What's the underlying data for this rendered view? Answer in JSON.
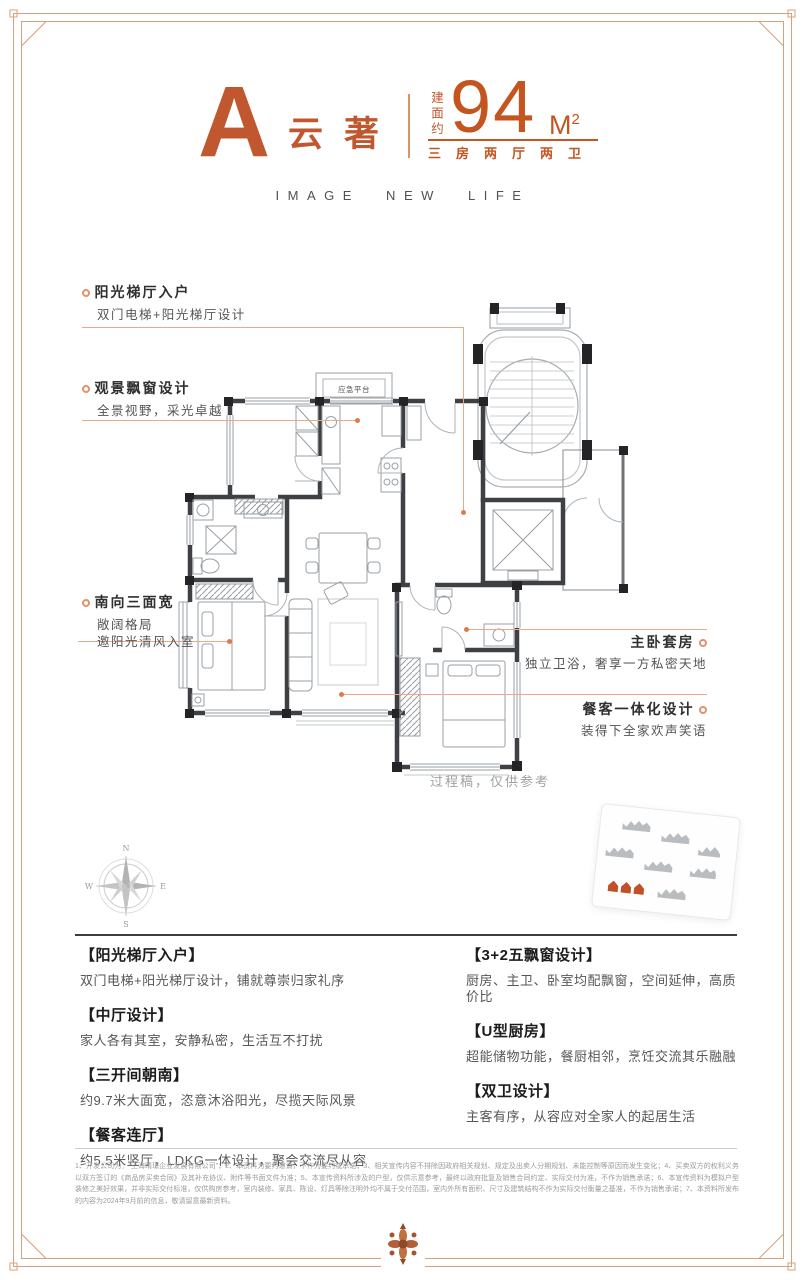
{
  "colors": {
    "accent": "#c0572e",
    "accent_bright": "#c4551f",
    "leader_line": "#eba98a",
    "leader_dot": "#df7a50",
    "wall": "#3f4043",
    "plan_line": "#9aa0a5",
    "title_dark": "#1c1c1c",
    "body_gray": "#565656"
  },
  "header": {
    "plan_letter": "A",
    "plan_name": "云著",
    "area_prefix": "建面约",
    "area_value": "94",
    "area_unit": "M",
    "area_sup": "2",
    "layout": "三房两厅两卫",
    "tagline": "IMAGE NEW LIFE"
  },
  "plan": {
    "platform_label": "应急平台",
    "note": "过程稿，仅供参考"
  },
  "compass": {
    "n": "N",
    "e": "E",
    "s": "S",
    "w": "W"
  },
  "callouts": {
    "left": [
      {
        "title": "阳光梯厅入户",
        "line1": "双门电梯+阳光梯厅设计",
        "line2": ""
      },
      {
        "title": "观景飘窗设计",
        "line1": "全景视野，采光卓越",
        "line2": ""
      },
      {
        "title": "南向三面宽",
        "line1": "敞阔格局",
        "line2": "邀阳光清风入室"
      }
    ],
    "right": [
      {
        "title": "主卧套房",
        "line1": "独立卫浴，奢享一方私密天地"
      },
      {
        "title": "餐客一体化设计",
        "line1": "装得下全家欢声笑语"
      }
    ]
  },
  "features": {
    "left": [
      {
        "title": "【阳光梯厅入户】",
        "body": "双门电梯+阳光梯厅设计，铺就尊崇归家礼序"
      },
      {
        "title": "【中厅设计】",
        "body": "家人各有其室，安静私密，生活互不打扰"
      },
      {
        "title": "【三开间朝南】",
        "body": "约9.7米大面宽，恣意沐浴阳光，尽揽天际风景"
      },
      {
        "title": "【餐客连厅】",
        "body": "约5.5米竖厅，LDKG一体设计，聚会交流尽从容"
      }
    ],
    "right": [
      {
        "title": "【3+2五飘窗设计】",
        "body": "厨房、主卫、卧室均配飘窗，空间延伸，高质价比"
      },
      {
        "title": "【U型厨房】",
        "body": "超能储物功能，餐厨相邻，烹饪交流其乐融融"
      },
      {
        "title": "【双卫设计】",
        "body": "主客有序，从容应对全家人的起居生活"
      }
    ]
  },
  "disclaimer": "1、开发公司为：“上海晴璟企业发展有限公司”；2、本资料为要约邀请，不作为要约或承诺；3、相关宣传内容不排除因政府相关规划、规定及出卖人分期规划、未能控制等原因而发生变化；4、买卖双方的权利义务以双方签订的《商品房买卖合同》及其补充协议、附件等书面文件为准；5、本宣传资料所涉及的户型，仅供示意参考，最终以政府批复及销售合同约定、实际交付为准，不作为销售承诺；6、本宣传资料为模拟户型装修之美好效果，并非实际交付标准，仅供购房参考，室内装修、家具、陈设、灯具等除注明外均不属于交付范围，室内外所有面积、尺寸及建筑结构不作为实际交付衡量之基准，不作为销售承诺；7、本资料所发布的内容为2024年9月前的信息，敬请留意最新资料。"
}
